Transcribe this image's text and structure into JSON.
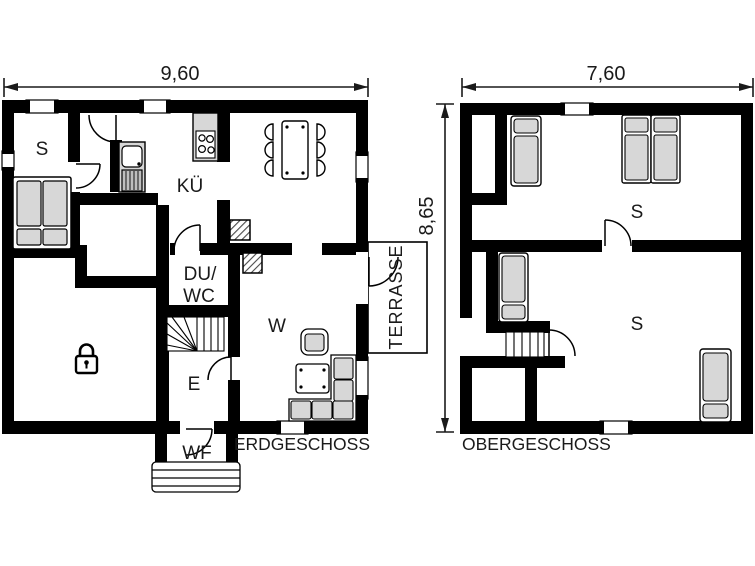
{
  "colors": {
    "wall": "#000000",
    "furniture": "#d7d7d7",
    "background": "#ffffff",
    "line": "#1a1a1a"
  },
  "dimensions": {
    "eg_width": "9,60",
    "og_width": "7,60",
    "shared_height": "8,65"
  },
  "erdgeschoss": {
    "floor_label": "ERDGESCHOSS",
    "rooms": {
      "bedroom": "S",
      "kitchen": "KÜ",
      "shower_wc_line1": "DU/",
      "shower_wc_line2": "WC",
      "living_room": "W",
      "entry": "E",
      "windbreak": "WF",
      "terrace": "TERRASSE"
    }
  },
  "obergeschoss": {
    "floor_label": "OBERGESCHOSS",
    "rooms": {
      "bedroom_top": "S",
      "bedroom_bottom": "S"
    }
  }
}
